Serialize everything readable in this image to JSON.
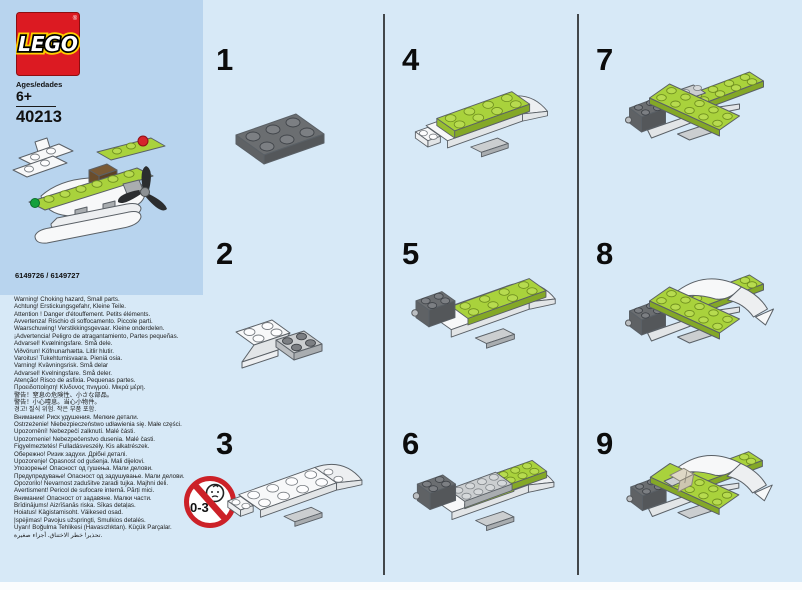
{
  "header": {
    "logo_text": "LEGO",
    "registered_mark": "®",
    "ages_label": "Ages/edades",
    "age_value": "6+",
    "set_number": "40213",
    "element_ids": "6149726 / 6149727"
  },
  "safety": {
    "icon_label": "0-3",
    "warning_lines": [
      "Warning! Choking hazard, Small parts.",
      "Achtung! Erstickungsgefahr, Kleine Teile.",
      "Attention ! Danger d'étouffement. Petits éléments.",
      "Avvertenza! Rischio di soffocamento. Piccole parti.",
      "Waarschuwing! Verstikkingsgevaar. Kleine onderdelen.",
      "¡Advertencia! Peligro de atragantamiento, Partes pequeñas.",
      "Advarsel! Kvælningsfare. Små dele.",
      "Viðvörun! Köfnunarhætta. Litlir hlutir.",
      "Varoitus! Tukehtumisvaara. Pieniä osia.",
      "Varning! Kvävningsrisk. Små delar",
      "Advarsel! Kvelningsfare. Små deler.",
      "Atenção! Risco de asfixia. Pequenas partes.",
      "Προειδοποίηση! Κίνδυνος πνιγμού. Μικρά μέρη.",
      "警告！窒息の危険性、小さな部品。",
      "警告！小心噎息。当心小物件。",
      "경고! 질식 위험. 작은 부품 포함.",
      "Внимание! Риск удушения. Мелкие детали.",
      "Ostrzeżenie! Niebezpieczeństwo udławienia się. Małe części.",
      "Upozornění! Nebezpečí zalknutí. Malé části.",
      "Upozornenie! Nebezpečenstvo dusenia. Malé časti.",
      "Figyelmeztetés! Fulladásveszély. Kis alkatrészek.",
      "Обережно! Ризик задухи. Дрібні деталі.",
      "Upozorenje! Opasnost od gušenja. Mali dijelovi.",
      "Упозорење! Опасност од гушења. Мали делови.",
      "Предупредување! Опасност од задушување. Мали делови.",
      "Opozorilo! Nevarnost zadušitve zaradi tujka. Majhni deli.",
      "Avertisment! Pericol de sufocare internă. Părți mici.",
      "Внимание! Опасност от задавяне. Малки части.",
      "Brīdinājums! Aizrīšanās riska. Sīkas detaļas.",
      "Hoiatus! Kägistamisoht. Väikesed osad.",
      "Įspėjimas! Pavojus užspringti, Smulkios detalės.",
      "Uyarı! Boğulma Tehlikesi (Havasızlıktan). Küçük Parçalar.",
      "تحذير! خطر الاختناق. أجزاء صغيرة."
    ]
  },
  "steps": [
    {
      "label": "1"
    },
    {
      "label": "2"
    },
    {
      "label": "3"
    },
    {
      "label": "4"
    },
    {
      "label": "5"
    },
    {
      "label": "6"
    },
    {
      "label": "7"
    },
    {
      "label": "8"
    },
    {
      "label": "9"
    }
  ],
  "colors": {
    "lego_red": "#dc1a22",
    "logo_yellow": "#ffcf00",
    "lime_green": "#a9d23c",
    "panel_blue": "#b8d4ee",
    "page_blue": "#d7e9f7",
    "divider_gray": "#42474b",
    "prohibition_red": "#cc2128"
  }
}
